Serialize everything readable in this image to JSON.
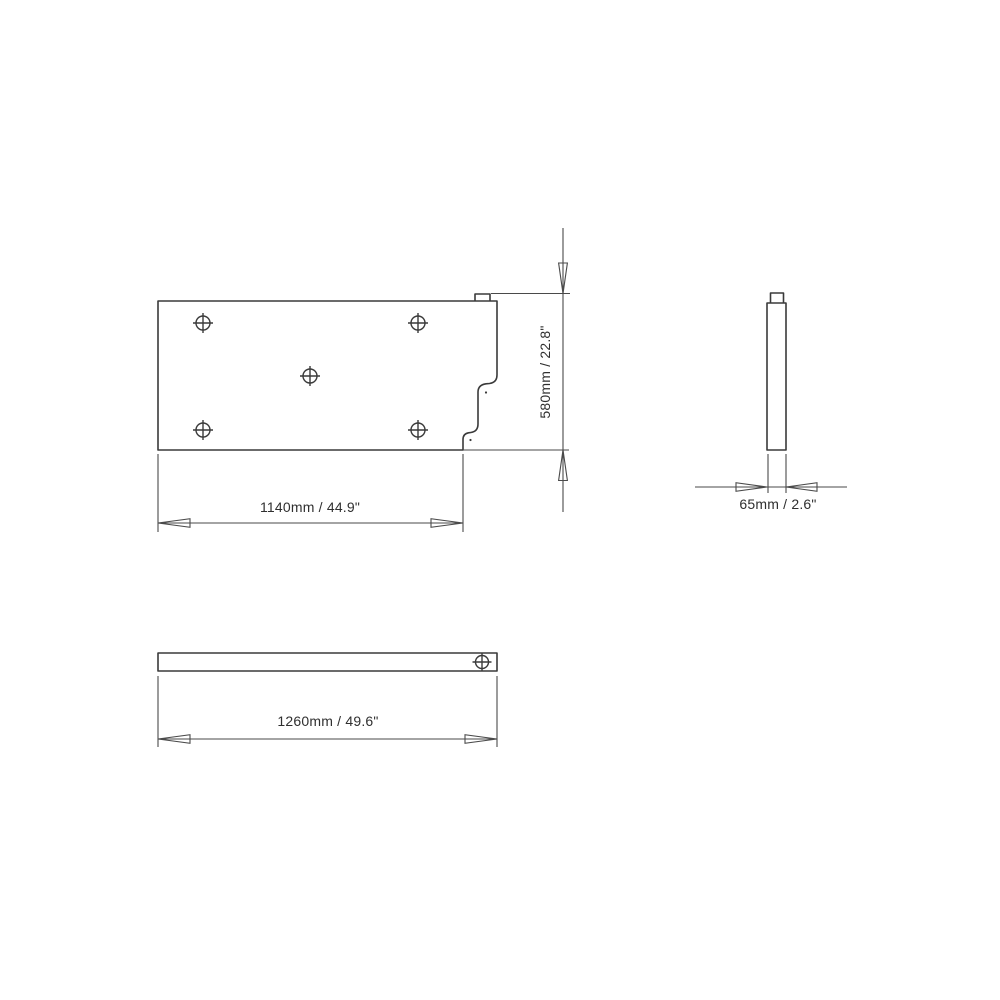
{
  "colors": {
    "background": "#ffffff",
    "line": "#3a3a3a",
    "dim_line": "#4a4a4a",
    "text": "#2f2f2f"
  },
  "views": {
    "front": {
      "width_dim": "1140mm / 44.9\"",
      "height_dim": "580mm / 22.8\""
    },
    "side": {
      "thickness_dim": "65mm / 2.6\""
    },
    "top": {
      "length_dim": "1260mm / 49.6\""
    }
  }
}
